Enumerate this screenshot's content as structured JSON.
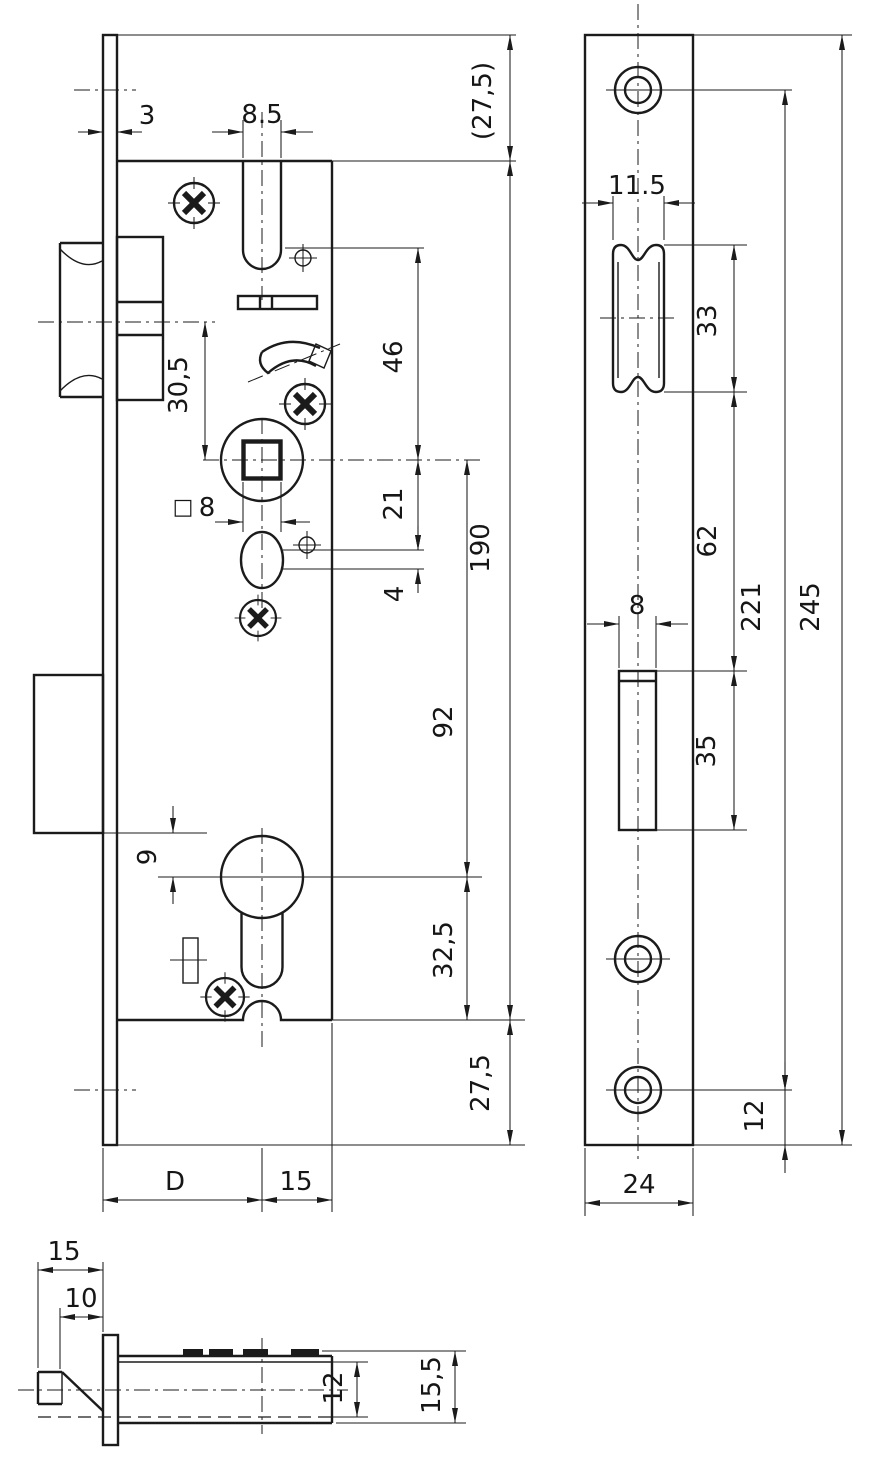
{
  "drawing": {
    "kind": "technical-drawing",
    "subject": "mortise-lock-dimensional-drawing",
    "colors": {
      "line": "#1b1b1b",
      "background": "#ffffff"
    }
  },
  "dims": {
    "main_view": {
      "plate_thickness": "3",
      "latch_slot_width": "8.5",
      "top_margin": "(27,5)",
      "slot_to_follower": "46",
      "latch_to_follower": "30,5",
      "spindle_symbol": "□",
      "spindle_size": "8",
      "follower_to_hole": "21",
      "hole_offset": "4",
      "case_height": "190",
      "follower_to_cylinder": "92",
      "bolt_to_cylinder": "9",
      "cylinder_to_bottom": "32,5",
      "bottom_margin": "27,5",
      "backset": "D",
      "behind_axis": "15"
    },
    "faceplate_view": {
      "cutout_width": "11.5",
      "cutout_height": "33",
      "cutout_gap": "62",
      "hole_spacing": "221",
      "plate_height": "245",
      "bolt_cutout_width": "8",
      "bolt_cutout_height": "35",
      "bottom_hole_offset": "12",
      "plate_width": "24"
    },
    "section_view": {
      "bolt_throw": "15",
      "bevel_length": "10",
      "bolt_height": "12",
      "case_depth": "15,5"
    }
  }
}
